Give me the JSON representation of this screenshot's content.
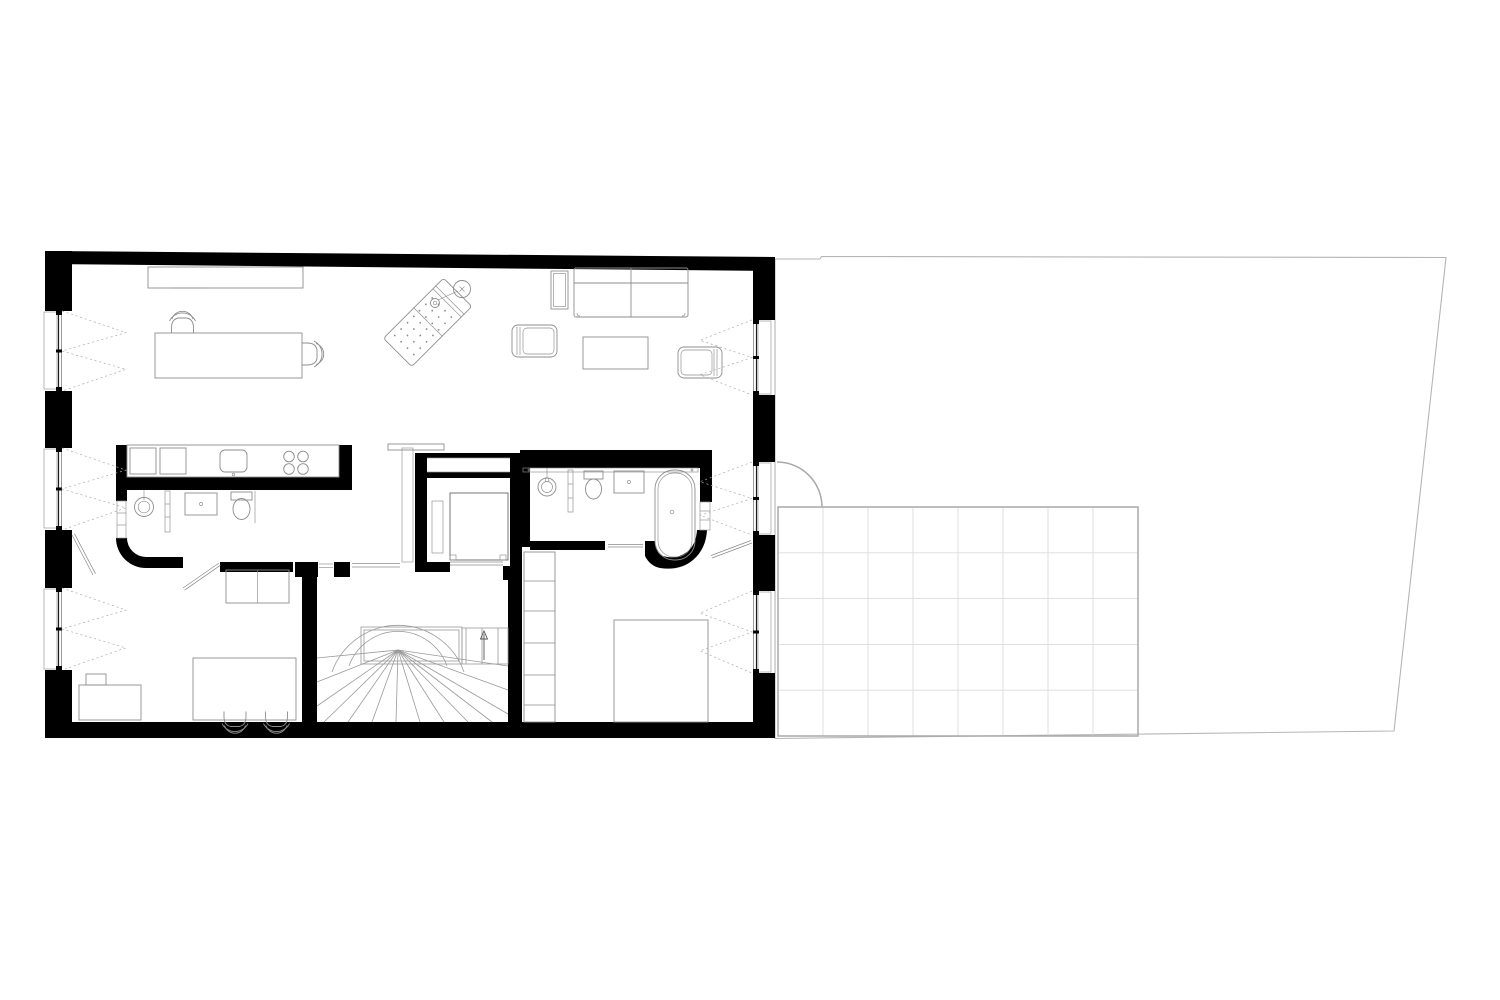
{
  "title": "apartment-floor-plan",
  "palette": {
    "paper": "#ffffff",
    "wall": "#000000",
    "furniture": "#8d8d8d",
    "furniture_dark": "#666666",
    "dashed": "#aaaaaa",
    "boundary": "#b5b5b5",
    "terrace_border": "#a9a9a9",
    "grid": "#dcdcdc"
  },
  "terrace": {
    "columns": 8,
    "rows": 5,
    "x0": 778,
    "y0": 507,
    "x1": 1138,
    "y1": 736
  },
  "openings": {
    "left_windows": 3,
    "right_windows": 3,
    "terrace_door_swing": true
  },
  "inventory": {
    "dining_chairs": 4,
    "sofa_seats": 2,
    "armchairs": 2,
    "cooktop_burners": 4,
    "bathrooms": 2,
    "elevator": 1,
    "stair_flights": 1
  },
  "chaise_dots": {
    "cols": 4,
    "rows_upper": 3,
    "rows_lower": 4,
    "spacing": 9
  }
}
